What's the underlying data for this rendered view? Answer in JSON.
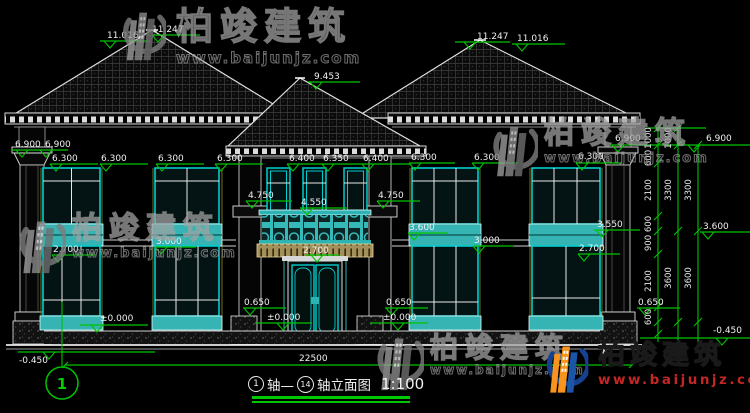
{
  "watermark": {
    "cn": "柏竣建筑",
    "url": "www.baijunjz.com"
  },
  "brand_colors": {
    "swoosh_blue": "#16418f",
    "building_orange": "#f7941d",
    "url_red": "#c22726",
    "dim_green": "#00c300",
    "window_teal": "#36b3b3"
  },
  "title": {
    "bubble1": "1",
    "mid": "轴—",
    "bubble2": "14",
    "suffix": "轴立面图",
    "scale": "1:100"
  },
  "axis_bubble": "1",
  "annotations": [
    {
      "v": "11.016",
      "x": 107,
      "y": 38
    },
    {
      "v": "11.247",
      "x": 152,
      "y": 32
    },
    {
      "v": "11.247",
      "x": 477,
      "y": 39
    },
    {
      "v": "11.016",
      "x": 517,
      "y": 41
    },
    {
      "v": "9.453",
      "x": 314,
      "y": 79
    },
    {
      "v": "6.900",
      "x": 15,
      "y": 147
    },
    {
      "v": "6.900",
      "x": 45,
      "y": 147
    },
    {
      "v": "6.900",
      "x": 615,
      "y": 141
    },
    {
      "v": "6.900",
      "x": 706,
      "y": 141
    },
    {
      "v": "6.300",
      "x": 52,
      "y": 161
    },
    {
      "v": "6.300",
      "x": 101,
      "y": 161
    },
    {
      "v": "6.300",
      "x": 158,
      "y": 161
    },
    {
      "v": "6.300",
      "x": 217,
      "y": 161
    },
    {
      "v": "6.400",
      "x": 289,
      "y": 161
    },
    {
      "v": "6.350",
      "x": 323,
      "y": 161
    },
    {
      "v": "6.400",
      "x": 363,
      "y": 161
    },
    {
      "v": "6.300",
      "x": 411,
      "y": 160
    },
    {
      "v": "6.300",
      "x": 474,
      "y": 160
    },
    {
      "v": "6.300",
      "x": 578,
      "y": 159
    },
    {
      "v": "4.750",
      "x": 248,
      "y": 198
    },
    {
      "v": "4.550",
      "x": 301,
      "y": 205
    },
    {
      "v": "4.750",
      "x": 378,
      "y": 198
    },
    {
      "v": "3.600",
      "x": 409,
      "y": 230
    },
    {
      "v": "3.550",
      "x": 597,
      "y": 227
    },
    {
      "v": "3.600",
      "x": 703,
      "y": 229
    },
    {
      "v": "3.000",
      "x": 156,
      "y": 244
    },
    {
      "v": "3.000",
      "x": 474,
      "y": 243
    },
    {
      "v": "2.700",
      "x": 53,
      "y": 252
    },
    {
      "v": "2.700",
      "x": 579,
      "y": 251
    },
    {
      "v": "2.700",
      "x": 303,
      "y": 253
    },
    {
      "v": "0.650",
      "x": 244,
      "y": 305
    },
    {
      "v": "0.650",
      "x": 386,
      "y": 305
    },
    {
      "v": "0.650",
      "x": 638,
      "y": 305
    },
    {
      "v": "±0.000",
      "x": 100,
      "y": 321
    },
    {
      "v": "±0.000",
      "x": 267,
      "y": 320
    },
    {
      "v": "±0.000",
      "x": 383,
      "y": 320
    },
    {
      "v": "-0.450",
      "x": 19,
      "y": 363
    },
    {
      "v": "-0.450",
      "x": 713,
      "y": 333
    },
    {
      "v": "22500",
      "x": 299,
      "y": 361
    },
    {
      "v": "1000",
      "x": 651,
      "y": 138,
      "rot": true
    },
    {
      "v": "1000",
      "x": 671,
      "y": 138,
      "rot": true
    },
    {
      "v": "600",
      "x": 651,
      "y": 158,
      "rot": true
    },
    {
      "v": "2100",
      "x": 651,
      "y": 190,
      "rot": true
    },
    {
      "v": "3300",
      "x": 671,
      "y": 190,
      "rot": true
    },
    {
      "v": "3300",
      "x": 691,
      "y": 190,
      "rot": true
    },
    {
      "v": "600",
      "x": 651,
      "y": 224,
      "rot": true
    },
    {
      "v": "900",
      "x": 651,
      "y": 243,
      "rot": true
    },
    {
      "v": "2100",
      "x": 651,
      "y": 281,
      "rot": true
    },
    {
      "v": "3600",
      "x": 671,
      "y": 278,
      "rot": true
    },
    {
      "v": "3600",
      "x": 691,
      "y": 278,
      "rot": true
    },
    {
      "v": "600",
      "x": 651,
      "y": 317,
      "rot": true
    },
    {
      "v": "1",
      "x": 62,
      "y": 389,
      "kind": "axis"
    }
  ]
}
